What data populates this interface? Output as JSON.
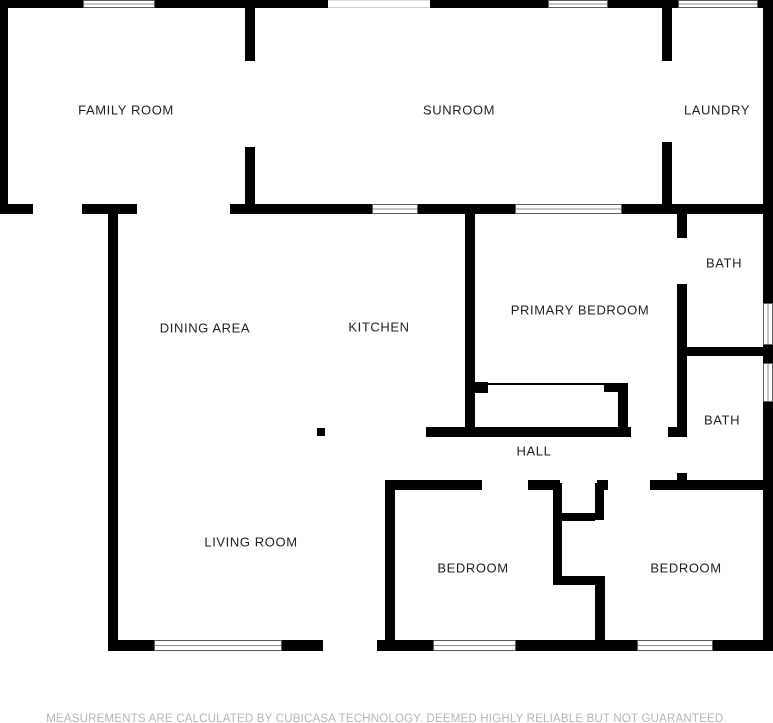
{
  "disclaimer": "MEASUREMENTS ARE CALCULATED BY CUBICASA TECHNOLOGY. DEEMED HIGHLY RELIABLE BUT NOT GUARANTEED.",
  "colors": {
    "wall": "#000000",
    "room_label": "#1f1f1f",
    "disclaimer_text": "#b5b5b5",
    "background": "#ffffff"
  },
  "floorplan": {
    "rooms": [
      {
        "name": "FAMILY ROOM",
        "cx": 126,
        "cy": 110
      },
      {
        "name": "SUNROOM",
        "cx": 459,
        "cy": 110
      },
      {
        "name": "LAUNDRY",
        "cx": 717,
        "cy": 110
      },
      {
        "name": "DINING AREA",
        "cx": 205,
        "cy": 328
      },
      {
        "name": "KITCHEN",
        "cx": 379,
        "cy": 327
      },
      {
        "name": "PRIMARY BEDROOM",
        "cx": 580,
        "cy": 310
      },
      {
        "name": "BATH",
        "cx": 724,
        "cy": 263
      },
      {
        "name": "BATH",
        "cx": 722,
        "cy": 420
      },
      {
        "name": "HALL",
        "cx": 534,
        "cy": 451
      },
      {
        "name": "LIVING ROOM",
        "cx": 251,
        "cy": 542
      },
      {
        "name": "BEDROOM",
        "cx": 473,
        "cy": 568
      },
      {
        "name": "BEDROOM",
        "cx": 686,
        "cy": 568
      }
    ],
    "walls": [
      [
        0,
        0,
        83,
        8
      ],
      [
        155,
        0,
        173,
        8
      ],
      [
        430,
        0,
        118,
        8
      ],
      [
        608,
        0,
        70,
        8
      ],
      [
        758,
        0,
        15,
        8
      ],
      [
        0,
        8,
        8,
        206
      ],
      [
        0,
        204,
        33,
        10
      ],
      [
        82,
        204,
        55,
        10
      ],
      [
        230,
        204,
        142,
        10
      ],
      [
        418,
        204,
        97,
        10
      ],
      [
        622,
        204,
        151,
        10
      ],
      [
        245,
        8,
        10,
        53
      ],
      [
        245,
        147,
        10,
        57
      ],
      [
        662,
        8,
        10,
        53
      ],
      [
        662,
        142,
        10,
        62
      ],
      [
        763,
        8,
        10,
        295
      ],
      [
        763,
        345,
        10,
        18
      ],
      [
        763,
        402,
        10,
        248
      ],
      [
        108,
        214,
        10,
        436
      ],
      [
        108,
        640,
        46,
        11
      ],
      [
        282,
        640,
        41,
        11
      ],
      [
        377,
        640,
        56,
        11
      ],
      [
        516,
        640,
        121,
        11
      ],
      [
        713,
        640,
        60,
        11
      ],
      [
        465,
        214,
        10,
        223
      ],
      [
        677,
        214,
        10,
        24
      ],
      [
        677,
        284,
        10,
        66
      ],
      [
        677,
        347,
        96,
        9
      ],
      [
        677,
        356,
        10,
        81
      ],
      [
        677,
        473,
        10,
        17
      ],
      [
        426,
        427,
        205,
        10
      ],
      [
        668,
        427,
        19,
        10
      ],
      [
        473,
        382,
        15,
        11
      ],
      [
        488,
        383,
        118,
        2
      ],
      [
        604,
        383,
        24,
        9
      ],
      [
        618,
        383,
        10,
        54
      ],
      [
        317,
        428,
        8,
        8
      ],
      [
        385,
        480,
        97,
        10
      ],
      [
        528,
        480,
        32,
        10
      ],
      [
        597,
        480,
        11,
        10
      ],
      [
        650,
        480,
        123,
        10
      ],
      [
        385,
        490,
        10,
        160
      ],
      [
        553,
        483,
        9,
        102
      ],
      [
        595,
        483,
        9,
        37
      ],
      [
        562,
        513,
        33,
        8
      ],
      [
        553,
        576,
        52,
        9
      ],
      [
        595,
        585,
        10,
        65
      ]
    ],
    "windows": [
      [
        83,
        0,
        72,
        8
      ],
      [
        548,
        0,
        60,
        8
      ],
      [
        678,
        0,
        80,
        8
      ],
      [
        372,
        204,
        46,
        10
      ],
      [
        515,
        204,
        107,
        10
      ],
      [
        154,
        640,
        128,
        11
      ],
      [
        433,
        640,
        83,
        11
      ],
      [
        637,
        640,
        76,
        11
      ],
      [
        763,
        303,
        10,
        42
      ],
      [
        763,
        363,
        10,
        39
      ]
    ],
    "faint_openings": [
      [
        328,
        0,
        102,
        8
      ]
    ]
  }
}
